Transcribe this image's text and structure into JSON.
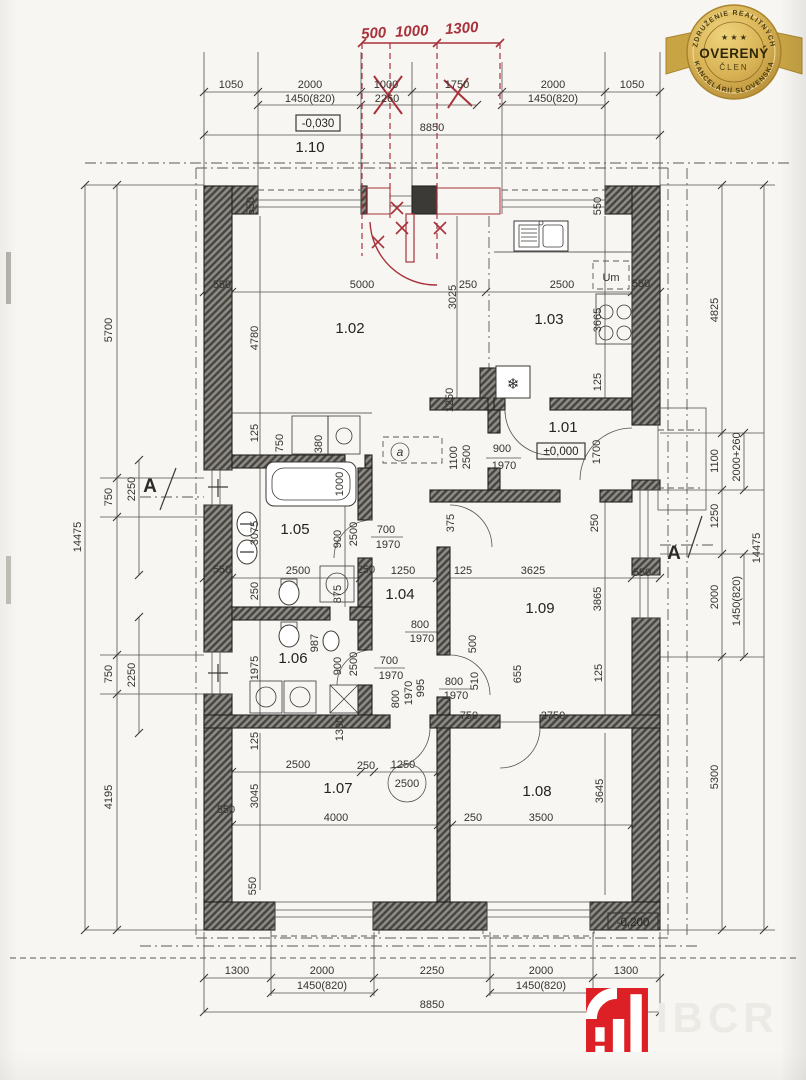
{
  "badge": {
    "arc_top": "ZDRUŽENIE REALITNÝCH",
    "arc_bottom": "KANCELÁRIÍ SLOVENSKA",
    "stars": "★ ★ ★",
    "title": "OVERENÝ",
    "subtitle": "ČLEN"
  },
  "logo": {
    "watermark": "IBCR"
  },
  "levels": {
    "top": "-0,030",
    "zero": "±0,000",
    "bottom": "-0,200"
  },
  "rooms": {
    "r101": "1.01",
    "r102": "1.02",
    "r103": "1.03",
    "r104": "1.04",
    "r105": "1.05",
    "r106": "1.06",
    "r107": "1.07",
    "r108": "1.08",
    "r109": "1.09",
    "r110": "1.10"
  },
  "red_notes": {
    "n1": "500",
    "n2": "1000",
    "n3": "1300"
  },
  "section": {
    "a": "A"
  },
  "access": {
    "a": "a"
  },
  "icons": {
    "snowflake": "❄"
  },
  "dims": {
    "top1": [
      "1050",
      "2000",
      "1000",
      "1750",
      "2000",
      "1050"
    ],
    "top2": [
      "1450(820)",
      "2260",
      "1450(820)"
    ],
    "top_total": "8850",
    "bottom1": [
      "1300",
      "2000",
      "2250",
      "2000",
      "1300"
    ],
    "bottom2": [
      "1450(820)",
      "1450(820)"
    ],
    "bottom_total": "8850",
    "left": [
      "5700",
      "750",
      "2250",
      "750",
      "2250",
      "4195"
    ],
    "left_total": "14475",
    "right": [
      "4825",
      "1100",
      "2000+260",
      "1250",
      "2000",
      "1450(820)",
      "5300"
    ],
    "right_total": "14475",
    "interior": [
      "550",
      "550",
      "550",
      "5000",
      "3025",
      "250",
      "4780",
      "1250",
      "2500",
      "550",
      "3665",
      "Um",
      "125",
      "900",
      "1970",
      "2500",
      "1100",
      "1700",
      "375",
      "250",
      "125",
      "3625",
      "550",
      "3865",
      "125",
      "750",
      "380",
      "1000",
      "3075",
      "900",
      "2500",
      "700",
      "1970",
      "550",
      "2500",
      "250",
      "250",
      "1250",
      "875",
      "1975",
      "987",
      "900",
      "2500",
      "700",
      "1970",
      "800",
      "1970",
      "995",
      "800",
      "1970",
      "800",
      "1970",
      "500",
      "510",
      "655",
      "125",
      "750",
      "2750",
      "1300",
      "125",
      "2500",
      "250",
      "1250",
      "2500",
      "3045",
      "4000",
      "550",
      "3645",
      "250",
      "3500",
      "550"
    ]
  }
}
